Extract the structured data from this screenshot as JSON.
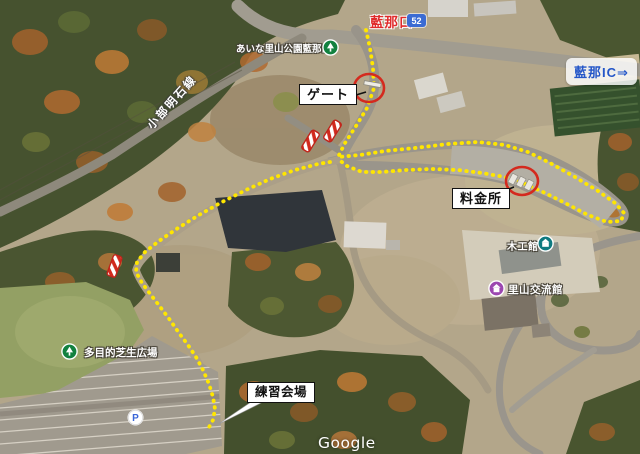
{
  "map": {
    "attribution": "Google",
    "road": {
      "name": "小部明石線",
      "route_number": "52"
    },
    "annotations": {
      "entrance": "藍那口",
      "ic_direction": "藍那IC⇒",
      "gate": "ゲート",
      "toll_booth": "料金所",
      "practice_venue": "練習会場"
    },
    "pois": {
      "park_entrance": "あいな里山公園藍那口",
      "woodworking_hall": "木工館",
      "exchange_hall": "里山交流館",
      "lawn": "多目的芝生広場",
      "parking": "P"
    },
    "colors": {
      "route_dots": "#ffe600",
      "marker_red": "#d42a1e",
      "entrance_text": "#e02b2b",
      "ic_text": "#2456c8",
      "shield_bg": "#3b6bd3"
    }
  }
}
